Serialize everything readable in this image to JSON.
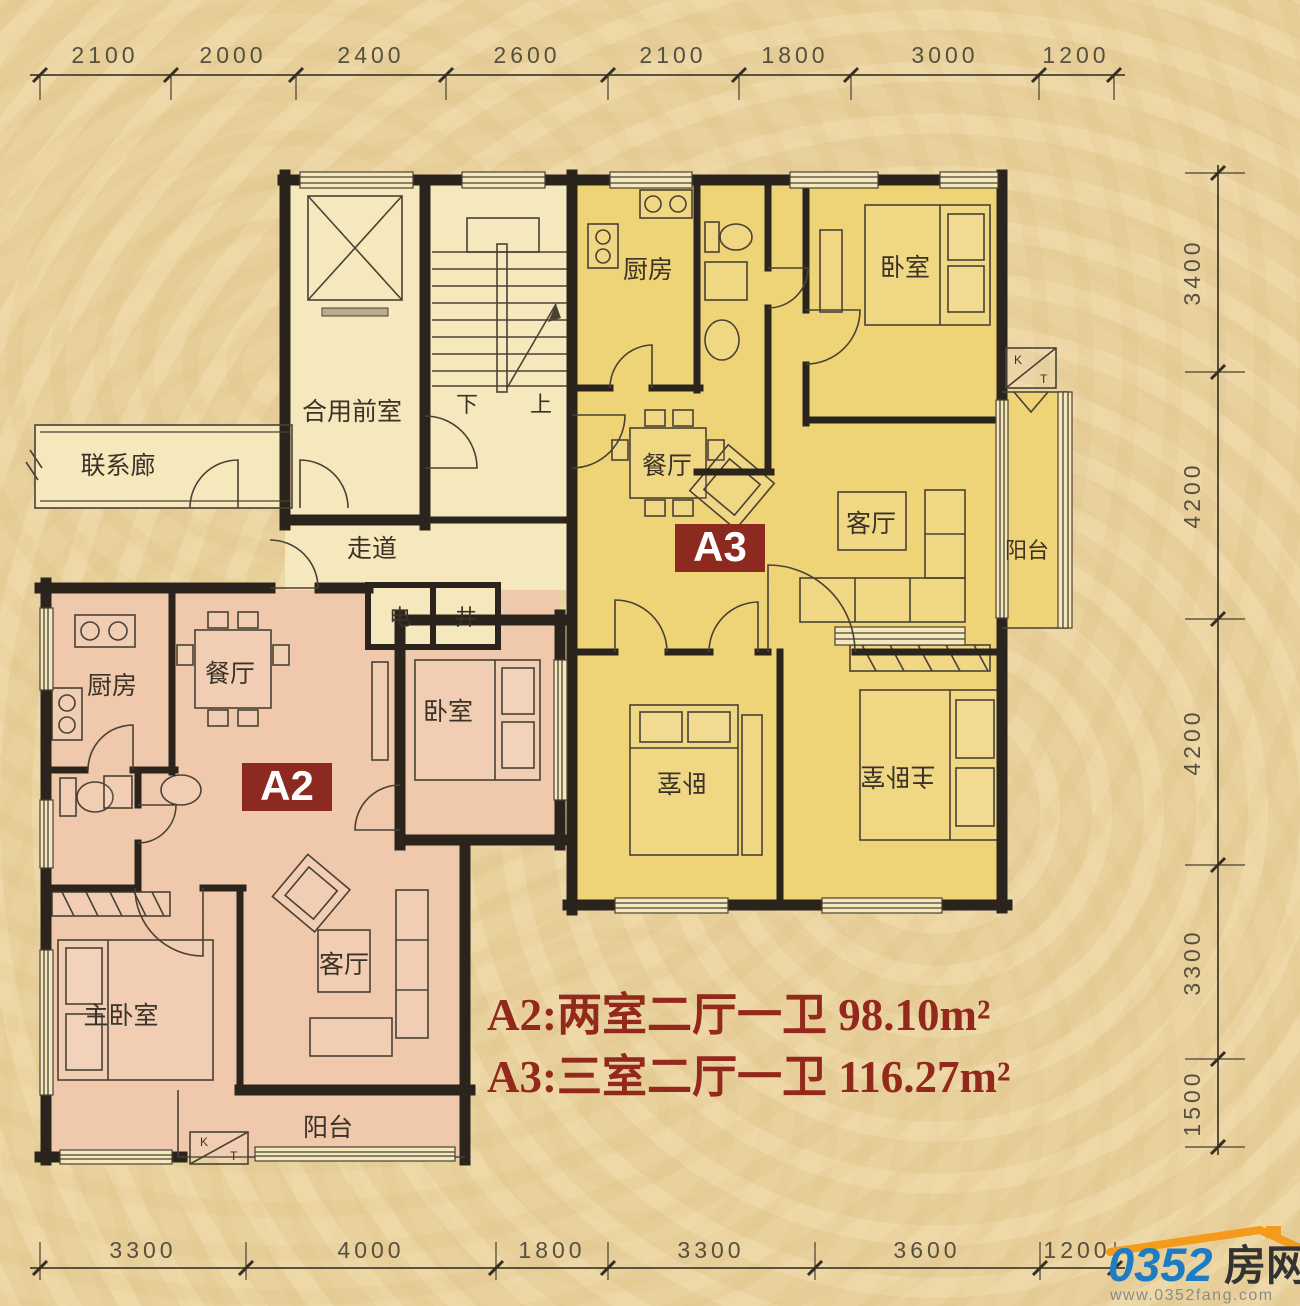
{
  "plan": {
    "legend": {
      "a2": "A2:两室二厅一卫 98.10m²",
      "a3": "A3:三室二厅一卫 116.27m²"
    },
    "badges": {
      "a2": "A2",
      "a3": "A3"
    },
    "dims": {
      "top": [
        "2100",
        "2000",
        "2400",
        "2600",
        "2100",
        "1800",
        "3000",
        "1200"
      ],
      "bottom": [
        "3300",
        "4000",
        "1800",
        "3300",
        "3600",
        "1200"
      ],
      "right": [
        "3400",
        "4200",
        "4200",
        "3300",
        "1500"
      ]
    },
    "rooms": {
      "a3_kitchen": "厨房",
      "a3_bedroom_top": "卧室",
      "a3_dining": "餐厅",
      "a3_living": "客厅",
      "a3_balcony": "阳台",
      "a3_bedroom_mid": "卧室",
      "a3_master": "主卧室",
      "a2_kitchen": "厨房",
      "a2_dining": "餐厅",
      "a2_bedroom": "卧室",
      "a2_living": "客厅",
      "a2_master": "主卧室",
      "a2_balcony": "阳台",
      "shared_front_room": "合用前室",
      "link_corridor": "联系廊",
      "corridor": "走道",
      "elec_shaft": "电",
      "well_shaft": "井",
      "stair_down": "下",
      "stair_up": "上"
    },
    "kt_box": {
      "k": "K",
      "t": "T"
    }
  },
  "logo": {
    "number": "0352",
    "name": "房网",
    "url": "www.0352fang.com"
  },
  "colors": {
    "background": "#e9d19e",
    "common_fill": "#f6e8bd",
    "a3_fill": "#eed377",
    "a2_fill": "#f0c8ab",
    "wall": "#2b241d",
    "accent_text": "#93291c",
    "badge_bg": "#8c2a20",
    "logo_blue": "#1e7dc2",
    "logo_orange": "#f49a1c"
  }
}
